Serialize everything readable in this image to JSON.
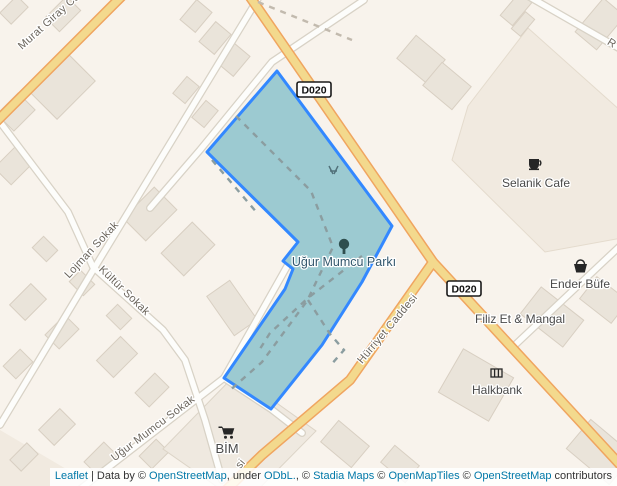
{
  "park": {
    "label": "Uğur Mumcu Parkı",
    "fill": "#9ccad1",
    "border": "#3388ff"
  },
  "shields": {
    "d020": "D020"
  },
  "streets": {
    "murat_giray": "Murat Giray Ca",
    "lojman": "Lojman Sokak",
    "kultur": "Kültür Sokak",
    "ugur_mumcu": "Uğur Mumcu Sokak",
    "hurriyet": "Hürriyet Caddesi",
    "hurriyet_clipped": "si",
    "top_right_clipped": "R"
  },
  "pois": {
    "selanik": "Selanik Cafe",
    "ender": "Ender Büfe",
    "filiz": "Filiz Et & Mangal",
    "halkbank": "Halkbank",
    "bim": "BİM"
  },
  "icons": {
    "selanik": "coffee-cup-icon",
    "ender": "shopping-basket-icon",
    "halkbank": "bank-icon",
    "bim": "shopping-cart-icon",
    "park_tree": "tree-icon",
    "park_playground": "playground-icon"
  },
  "colors": {
    "land": "#f8f3ec",
    "landuse_block": "#f1eae0",
    "building": "#eae4da",
    "road_major_fill": "#f3d98d",
    "road_major_casing": "#f0a560",
    "road_minor_fill": "#fdfdfb",
    "road_minor_casing": "#d8d2c6",
    "park_fill": "#9ccad1",
    "park_border": "#3388ff",
    "path_dash": "#8b9da0",
    "link": "#0078a8"
  },
  "attribution": {
    "segments": [
      {
        "text": "Leaflet",
        "link": true
      },
      {
        "text": " | Data by © ",
        "link": false
      },
      {
        "text": "OpenStreetMap",
        "link": true
      },
      {
        "text": ", under ",
        "link": false
      },
      {
        "text": "ODbL.",
        "link": true
      },
      {
        "text": ", © ",
        "link": false
      },
      {
        "text": "Stadia Maps",
        "link": true
      },
      {
        "text": " © ",
        "link": false
      },
      {
        "text": "OpenMapTiles",
        "link": true
      },
      {
        "text": " © ",
        "link": false
      },
      {
        "text": "OpenStreetMap",
        "link": true
      },
      {
        "text": " contributors",
        "link": false
      }
    ]
  }
}
